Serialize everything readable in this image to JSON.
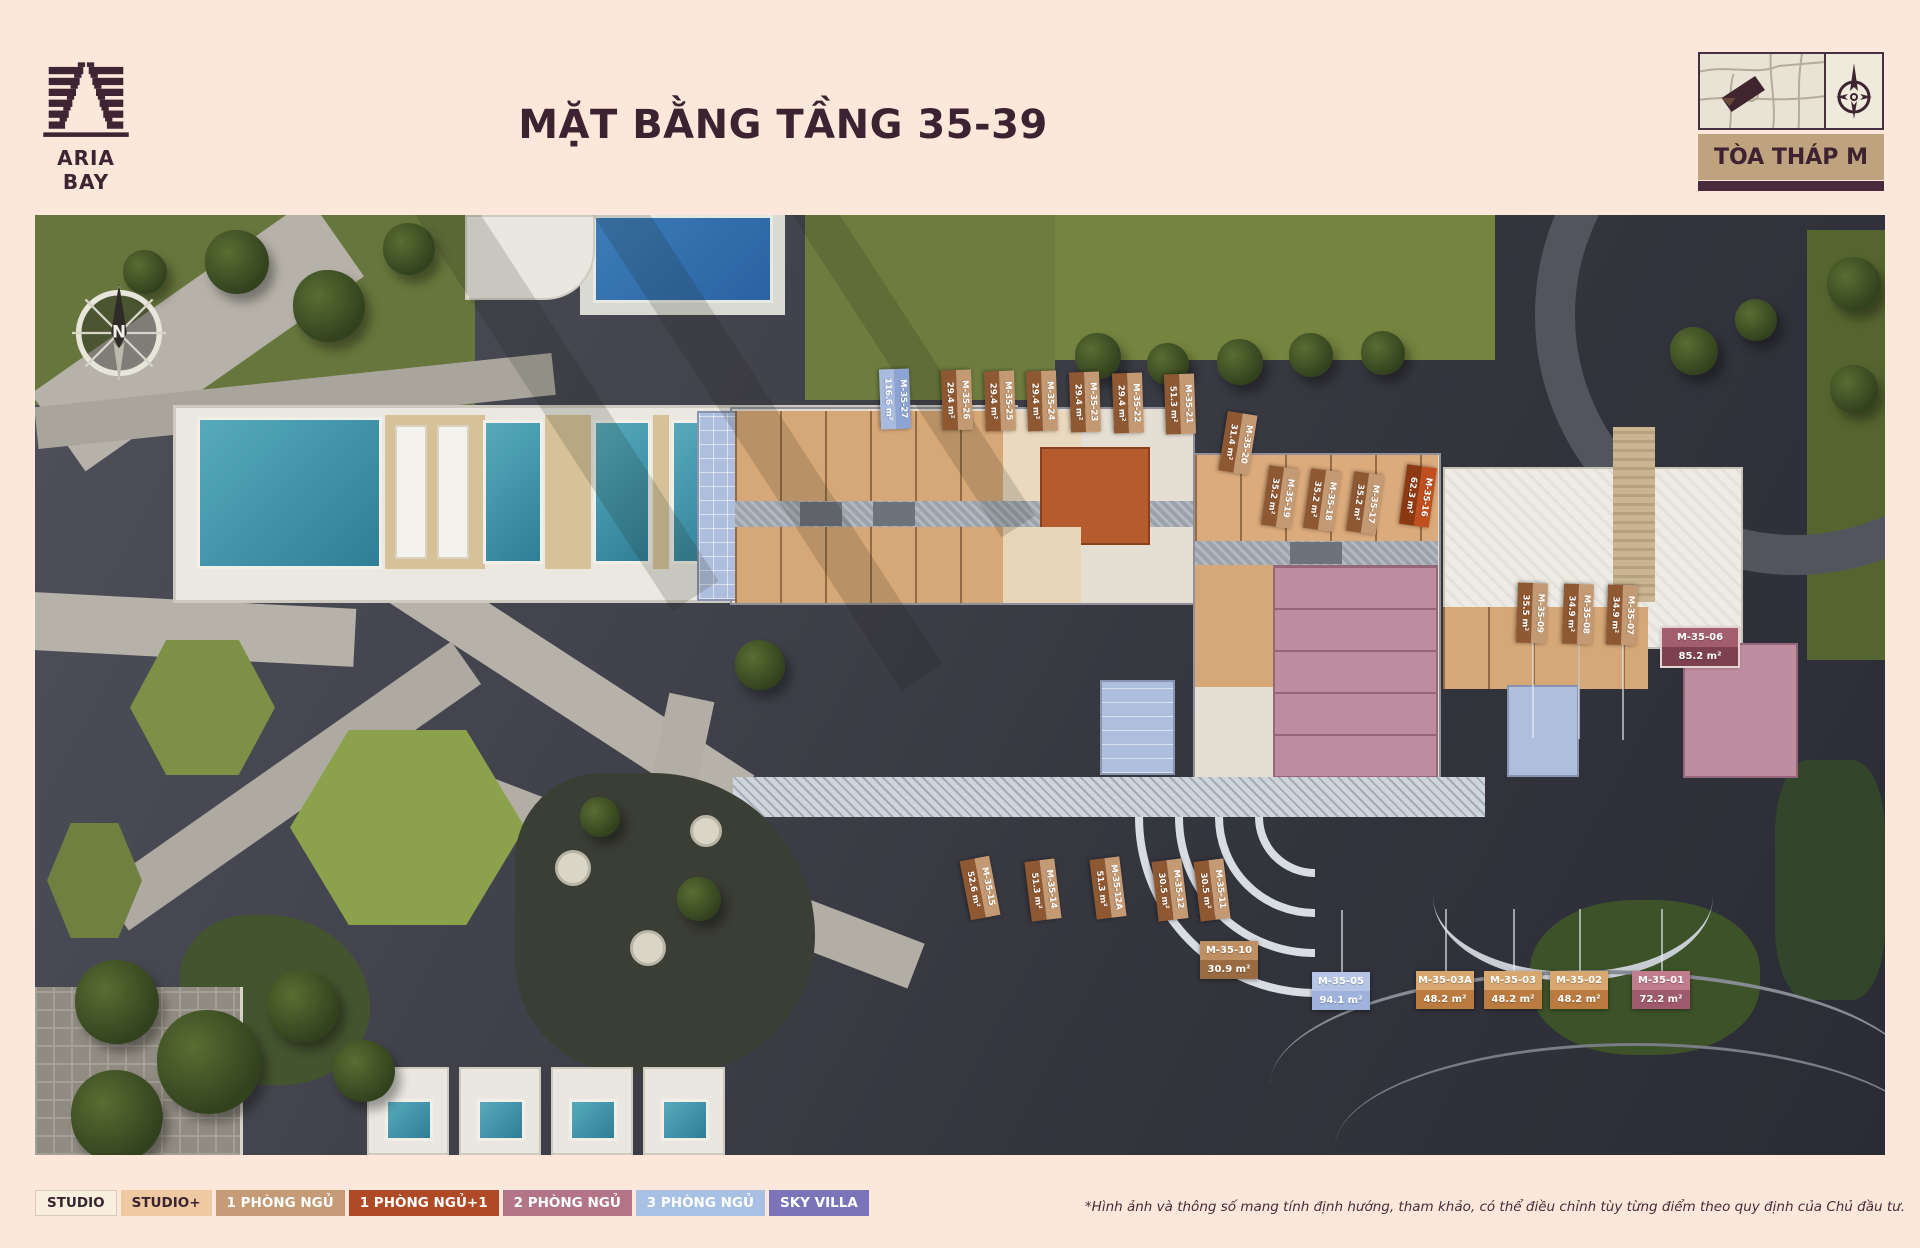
{
  "header": {
    "brand": "ARIA BAY",
    "title": "MẶT BẰNG TẦNG 35-39",
    "tower_badge": "TÒA THÁP M"
  },
  "icons": {
    "logo": "aria-bay-twin-tower-m-logo",
    "locator_map": "site-locator-map",
    "compass_small": "compass-rose-small",
    "compass_plan": "compass-rose-north",
    "north_label": "N"
  },
  "colors": {
    "page_bg": "#FBE8DB",
    "brand_maroon": "#3E2231",
    "badge_tan": "#BFA27E"
  },
  "legend": [
    {
      "label": "STUDIO",
      "bg": "#F8EFDF",
      "fg": "#3A2430",
      "border": "#D9C9B4"
    },
    {
      "label": "STUDIO+",
      "bg": "#EFC9A2",
      "fg": "#3A2430",
      "border": null
    },
    {
      "label": "1 PHÒNG NGỦ",
      "bg": "#C59A76",
      "fg": "#FFFFFF",
      "border": null
    },
    {
      "label": "1 PHÒNG NGỦ+1",
      "bg": "#B04A26",
      "fg": "#FFFFFF",
      "border": null
    },
    {
      "label": "2 PHÒNG NGỦ",
      "bg": "#B37487",
      "fg": "#FFFFFF",
      "border": null
    },
    {
      "label": "3 PHÒNG NGỦ",
      "bg": "#A7C0E4",
      "fg": "#FFFFFF",
      "border": null
    },
    {
      "label": "SKY VILLA",
      "bg": "#7B74B8",
      "fg": "#FFFFFF",
      "border": null
    }
  ],
  "footnote": "*Hình ảnh và thông số mang tính định hướng, tham khảo, có thể điều chỉnh tùy từng điểm theo quy định của Chủ đầu tư.",
  "units": [
    {
      "id": "M-35-27",
      "area": "116.6 m²",
      "o": "v",
      "cx": 860,
      "cy": 184,
      "rot": 88,
      "c1": "#8CA3D3",
      "c2": "#A9BADF"
    },
    {
      "id": "M-35-26",
      "area": "29.4 m²",
      "o": "v",
      "cx": 922,
      "cy": 185,
      "rot": 88,
      "c1": "#C49A74",
      "c2": "#8E5833"
    },
    {
      "id": "M-35-25",
      "area": "29.4 m²",
      "o": "v",
      "cx": 965,
      "cy": 186,
      "rot": 88,
      "c1": "#C49A74",
      "c2": "#8E5833"
    },
    {
      "id": "M-35-24",
      "area": "29.4 m²",
      "o": "v",
      "cx": 1007,
      "cy": 186,
      "rot": 88,
      "c1": "#C49A74",
      "c2": "#8E5833"
    },
    {
      "id": "M-35-23",
      "area": "29.4 m²",
      "o": "v",
      "cx": 1050,
      "cy": 187,
      "rot": 88,
      "c1": "#C49A74",
      "c2": "#8E5833"
    },
    {
      "id": "M-35-22",
      "area": "29.4 m²",
      "o": "v",
      "cx": 1093,
      "cy": 188,
      "rot": 88,
      "c1": "#C49A74",
      "c2": "#8E5833"
    },
    {
      "id": "M-35-21",
      "area": "51.3 m²",
      "o": "v",
      "cx": 1145,
      "cy": 189,
      "rot": 88,
      "c1": "#C49A74",
      "c2": "#8E5833"
    },
    {
      "id": "M-35-20",
      "area": "31.4 m²",
      "o": "v",
      "cx": 1203,
      "cy": 228,
      "rot": 99,
      "c1": "#C49A74",
      "c2": "#8E5833"
    },
    {
      "id": "M-35-19",
      "area": "35.2 m²",
      "o": "v",
      "cx": 1245,
      "cy": 282,
      "rot": 98,
      "c1": "#C49A74",
      "c2": "#8E5833"
    },
    {
      "id": "M-35-18",
      "area": "35.2 m²",
      "o": "v",
      "cx": 1287,
      "cy": 285,
      "rot": 98,
      "c1": "#C49A74",
      "c2": "#8E5833"
    },
    {
      "id": "M-35-17",
      "area": "35.2 m²",
      "o": "v",
      "cx": 1330,
      "cy": 288,
      "rot": 98,
      "c1": "#C49A74",
      "c2": "#8E5833"
    },
    {
      "id": "M-35-16",
      "area": "62.3 m²",
      "o": "v",
      "cx": 1383,
      "cy": 281,
      "rot": 98,
      "c1": "#BF4F1F",
      "c2": "#8C3813"
    },
    {
      "id": "M-35-09",
      "area": "35.5 m²",
      "o": "v",
      "cx": 1497,
      "cy": 398,
      "rot": 92,
      "c1": "#C49A74",
      "c2": "#8E5833",
      "leader": "down"
    },
    {
      "id": "M-35-08",
      "area": "34.9 m²",
      "o": "v",
      "cx": 1543,
      "cy": 399,
      "rot": 92,
      "c1": "#C49A74",
      "c2": "#8E5833",
      "leader": "down"
    },
    {
      "id": "M-35-07",
      "area": "34.9 m²",
      "o": "v",
      "cx": 1587,
      "cy": 400,
      "rot": 92,
      "c1": "#C49A74",
      "c2": "#8E5833",
      "leader": "down"
    },
    {
      "id": "M-35-06",
      "area": "85.2 m²",
      "o": "h",
      "cx": 1665,
      "cy": 432,
      "rot": 0,
      "w": 76,
      "c1": "#A35E6E",
      "c2": "#7D4050",
      "border": "#E3D4D2"
    },
    {
      "id": "M-35-15",
      "area": "52.6 m²",
      "o": "v",
      "cx": 945,
      "cy": 673,
      "rot": 79,
      "c1": "#C49A74",
      "c2": "#8E5833"
    },
    {
      "id": "M-35-14",
      "area": "51.3 m²",
      "o": "v",
      "cx": 1008,
      "cy": 675,
      "rot": 83,
      "c1": "#C49A74",
      "c2": "#8E5833"
    },
    {
      "id": "M-35-12A",
      "area": "51.3 m²",
      "o": "v",
      "cx": 1073,
      "cy": 673,
      "rot": 83,
      "c1": "#C49A74",
      "c2": "#8E5833"
    },
    {
      "id": "M-35-12",
      "area": "30.5 m²",
      "o": "v",
      "cx": 1135,
      "cy": 675,
      "rot": 83,
      "c1": "#C49A74",
      "c2": "#8E5833"
    },
    {
      "id": "M-35-11",
      "area": "30.5 m²",
      "o": "v",
      "cx": 1177,
      "cy": 675,
      "rot": 83,
      "c1": "#C49A74",
      "c2": "#8E5833"
    },
    {
      "id": "M-35-10",
      "area": "30.9 m²",
      "o": "h",
      "cx": 1194,
      "cy": 745,
      "rot": 0,
      "c1": "#BE8F63",
      "c2": "#9A6A42"
    },
    {
      "id": "M-35-05",
      "area": "94.1 m²",
      "o": "h",
      "cx": 1306,
      "cy": 776,
      "rot": 0,
      "c1": "#B6C5E6",
      "c2": "#9FB2DB",
      "leader": "up"
    },
    {
      "id": "M-35-03A",
      "area": "48.2 m²",
      "o": "h",
      "cx": 1410,
      "cy": 775,
      "rot": 0,
      "c1": "#D7A76F",
      "c2": "#BA7B41",
      "leader": "up"
    },
    {
      "id": "M-35-03",
      "area": "48.2 m²",
      "o": "h",
      "cx": 1478,
      "cy": 775,
      "rot": 0,
      "c1": "#D7A76F",
      "c2": "#BA7B41",
      "leader": "up"
    },
    {
      "id": "M-35-02",
      "area": "48.2 m²",
      "o": "h",
      "cx": 1544,
      "cy": 775,
      "rot": 0,
      "c1": "#D7A76F",
      "c2": "#BA7B41",
      "leader": "up"
    },
    {
      "id": "M-35-01",
      "area": "72.2 m²",
      "o": "h",
      "cx": 1626,
      "cy": 775,
      "rot": 0,
      "c1": "#C17C8E",
      "c2": "#A05A6E",
      "leader": "up"
    }
  ]
}
